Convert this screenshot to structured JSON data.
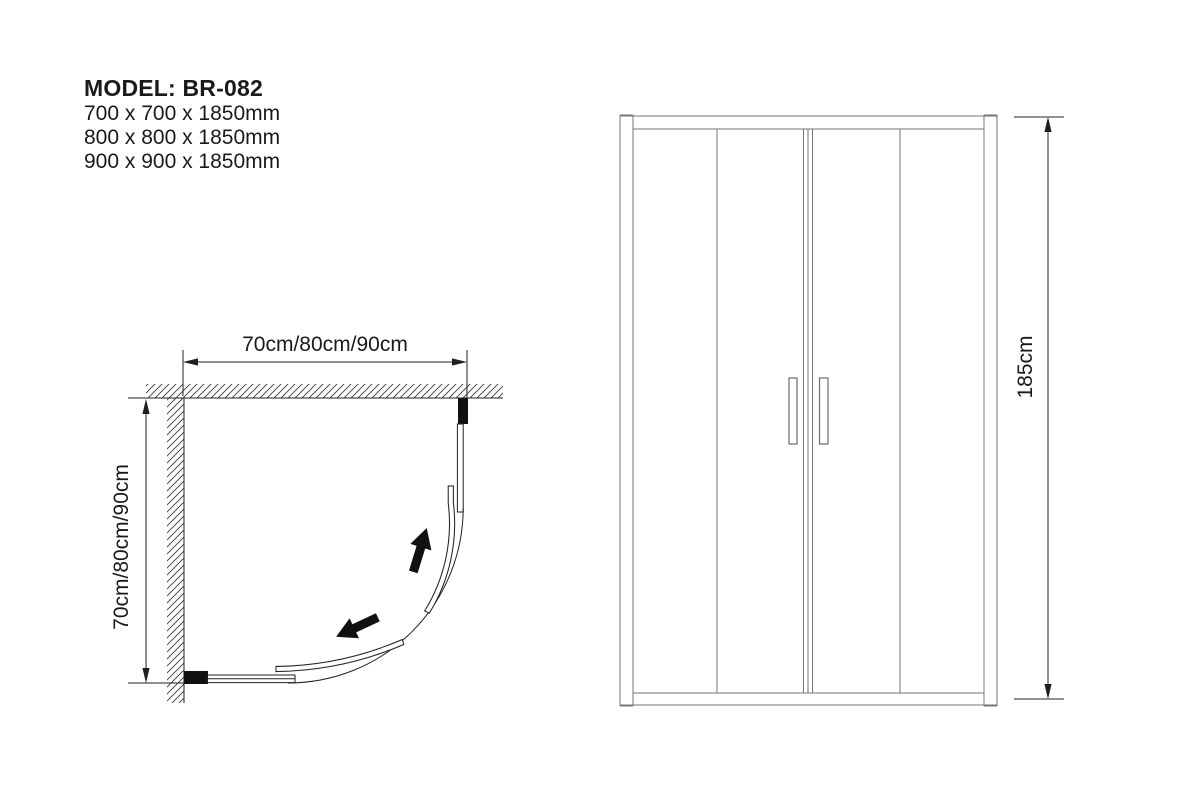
{
  "header": {
    "model_line": "MODEL: BR-082",
    "sizes": [
      "700 x 700 x 1850mm",
      "800 x 800 x 1850mm",
      "900 x 900 x 1850mm"
    ]
  },
  "plan_view": {
    "width_label": "70cm/80cm/90cm",
    "depth_label": "70cm/80cm/90cm"
  },
  "elevation_view": {
    "height_label": "185cm"
  },
  "colors": {
    "background": "#ffffff",
    "text": "#1a1a1a",
    "dimension_line": "#1f1f1f",
    "plan_line": "#222222",
    "elevation_line": "#757575",
    "solid_fill": "#111111"
  }
}
